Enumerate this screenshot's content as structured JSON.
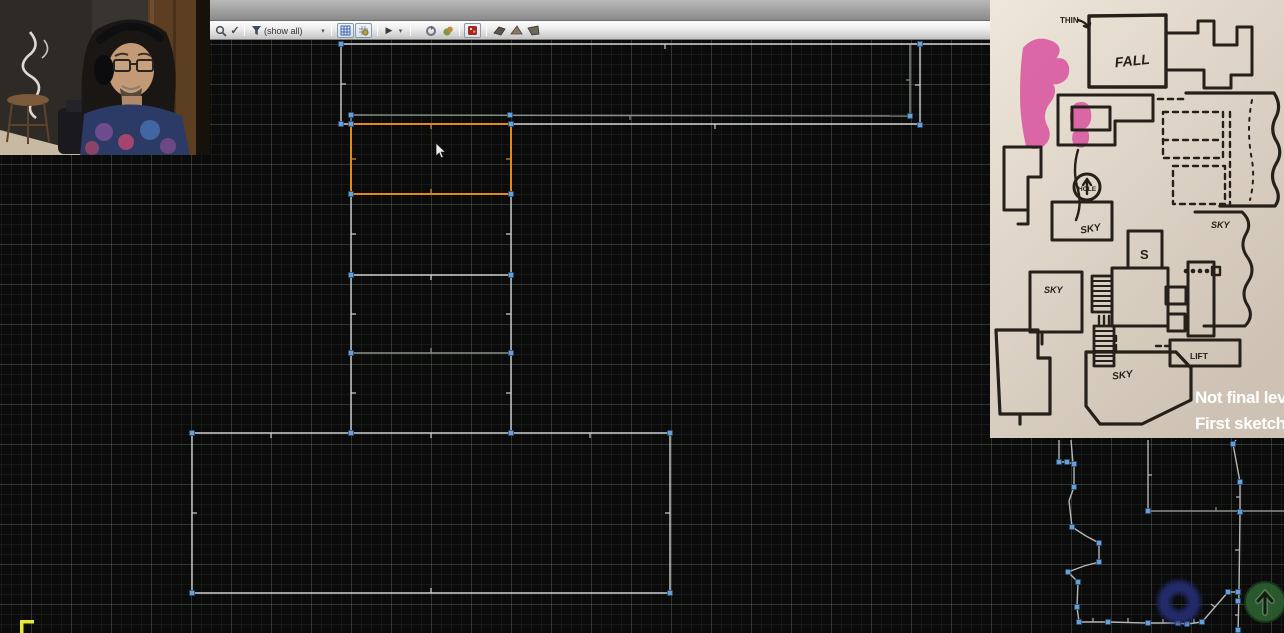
{
  "toolbar": {
    "filter_value": "(show all)",
    "play_glyph": "▶",
    "dropdown_glyph": "▾",
    "check_glyph": "✓"
  },
  "editor": {
    "colors": {
      "w": "#cfcfcf",
      "g": "#8b918b",
      "o": "#e1891f",
      "l": "#b7b7b7",
      "vertex": "#63a0dc",
      "thing_blue": "#202c6a",
      "thing_green": "#2c5f30"
    },
    "segments": [
      [
        341,
        44,
        992,
        44,
        "w"
      ],
      [
        341,
        44,
        341,
        124,
        "w"
      ],
      [
        920,
        45,
        920,
        125,
        "w"
      ],
      [
        910,
        45,
        910,
        116,
        "g"
      ],
      [
        351,
        115,
        910,
        116,
        "g"
      ],
      [
        341,
        124,
        920,
        124,
        "w"
      ],
      [
        351,
        115,
        351,
        124,
        "g"
      ],
      [
        192,
        433,
        670,
        433,
        "w"
      ],
      [
        192,
        433,
        192,
        593,
        "w"
      ],
      [
        670,
        433,
        670,
        593,
        "w"
      ],
      [
        192,
        593,
        670,
        593,
        "w"
      ],
      [
        351,
        194,
        351,
        433,
        "w"
      ],
      [
        511,
        194,
        511,
        433,
        "w"
      ],
      [
        351,
        275,
        511,
        275,
        "w"
      ],
      [
        351,
        353,
        511,
        353,
        "g"
      ],
      [
        351,
        124,
        511,
        124,
        "o"
      ],
      [
        351,
        124,
        351,
        194,
        "o"
      ],
      [
        511,
        124,
        511,
        194,
        "o"
      ],
      [
        351,
        194,
        511,
        194,
        "o"
      ],
      [
        1148,
        440,
        1148,
        511,
        "l"
      ],
      [
        1148,
        511,
        1284,
        511,
        "g"
      ],
      [
        1059,
        440,
        1059,
        462,
        "l"
      ],
      [
        1059,
        462,
        1067,
        462,
        "l"
      ],
      [
        1067,
        462,
        1074,
        464,
        "l"
      ],
      [
        1071,
        440,
        1073,
        464,
        "l"
      ],
      [
        1074,
        464,
        1074,
        487,
        "l"
      ],
      [
        1074,
        487,
        1069,
        501,
        "l"
      ],
      [
        1069,
        501,
        1072,
        527,
        "l"
      ],
      [
        1072,
        527,
        1086,
        536,
        "l"
      ],
      [
        1086,
        536,
        1099,
        543,
        "l"
      ],
      [
        1099,
        543,
        1099,
        562,
        "l"
      ],
      [
        1099,
        562,
        1084,
        566,
        "l"
      ],
      [
        1084,
        566,
        1068,
        572,
        "l"
      ],
      [
        1068,
        572,
        1078,
        582,
        "l"
      ],
      [
        1078,
        582,
        1077,
        607,
        "l"
      ],
      [
        1077,
        607,
        1079,
        622,
        "l"
      ],
      [
        1079,
        622,
        1108,
        622,
        "l"
      ],
      [
        1108,
        622,
        1148,
        623,
        "l"
      ],
      [
        1148,
        623,
        1178,
        623,
        "l"
      ],
      [
        1178,
        623,
        1187,
        624,
        "l"
      ],
      [
        1187,
        624,
        1202,
        622,
        "l"
      ],
      [
        1202,
        622,
        1228,
        592,
        "l"
      ],
      [
        1228,
        592,
        1238,
        592,
        "l"
      ],
      [
        1236,
        440,
        1233,
        444,
        "l"
      ],
      [
        1233,
        444,
        1240,
        482,
        "l"
      ],
      [
        1240,
        482,
        1240,
        512,
        "l"
      ],
      [
        1240,
        512,
        1239,
        592,
        "l"
      ],
      [
        1239,
        592,
        1238,
        633,
        "l"
      ]
    ],
    "ticks": [
      [
        665,
        44,
        665,
        49,
        "w"
      ],
      [
        341,
        84,
        346,
        84,
        "w"
      ],
      [
        920,
        85,
        915,
        85,
        "w"
      ],
      [
        910,
        80,
        906,
        80,
        "g"
      ],
      [
        630,
        115,
        630,
        120,
        "g"
      ],
      [
        715,
        124,
        715,
        129,
        "w"
      ],
      [
        431,
        124,
        431,
        129,
        "o"
      ],
      [
        431,
        194,
        431,
        189,
        "o"
      ],
      [
        351,
        159,
        356,
        159,
        "o"
      ],
      [
        511,
        159,
        506,
        159,
        "o"
      ],
      [
        351,
        234,
        356,
        234,
        "w"
      ],
      [
        351,
        314,
        356,
        314,
        "w"
      ],
      [
        351,
        393,
        356,
        393,
        "w"
      ],
      [
        511,
        234,
        506,
        234,
        "w"
      ],
      [
        511,
        314,
        506,
        314,
        "w"
      ],
      [
        511,
        393,
        506,
        393,
        "w"
      ],
      [
        431,
        275,
        431,
        280,
        "w"
      ],
      [
        431,
        353,
        431,
        348,
        "g"
      ],
      [
        271,
        433,
        271,
        438,
        "w"
      ],
      [
        431,
        433,
        431,
        438,
        "w"
      ],
      [
        590,
        433,
        590,
        438,
        "w"
      ],
      [
        192,
        513,
        197,
        513,
        "w"
      ],
      [
        670,
        513,
        665,
        513,
        "w"
      ],
      [
        431,
        593,
        431,
        588,
        "w"
      ],
      [
        1148,
        475,
        1152,
        475,
        "l"
      ],
      [
        1216,
        511,
        1216,
        507,
        "g"
      ],
      [
        1093,
        622,
        1093,
        618,
        "l"
      ],
      [
        1128,
        622,
        1128,
        618,
        "l"
      ],
      [
        1163,
        623,
        1163,
        619,
        "l"
      ],
      [
        1194,
        623,
        1194,
        619,
        "l"
      ],
      [
        1215,
        607,
        1211,
        604,
        "l"
      ],
      [
        1240,
        497,
        1236,
        497,
        "l"
      ],
      [
        1239,
        550,
        1235,
        550,
        "l"
      ],
      [
        1239,
        615,
        1235,
        615,
        "l"
      ]
    ],
    "vertices": [
      [
        341,
        44
      ],
      [
        920,
        44
      ],
      [
        351,
        115
      ],
      [
        510,
        115
      ],
      [
        910,
        116
      ],
      [
        341,
        124
      ],
      [
        351,
        124
      ],
      [
        511,
        124
      ],
      [
        920,
        125
      ],
      [
        351,
        194
      ],
      [
        511,
        194
      ],
      [
        351,
        275
      ],
      [
        511,
        275
      ],
      [
        351,
        353
      ],
      [
        511,
        353
      ],
      [
        192,
        433
      ],
      [
        351,
        433
      ],
      [
        511,
        433
      ],
      [
        670,
        433
      ],
      [
        192,
        593
      ],
      [
        670,
        593
      ],
      [
        1059,
        462
      ],
      [
        1067,
        462
      ],
      [
        1074,
        464
      ],
      [
        1074,
        487
      ],
      [
        1072,
        527
      ],
      [
        1099,
        543
      ],
      [
        1099,
        562
      ],
      [
        1068,
        572
      ],
      [
        1078,
        582
      ],
      [
        1077,
        607
      ],
      [
        1079,
        622
      ],
      [
        1108,
        622
      ],
      [
        1148,
        623
      ],
      [
        1178,
        623
      ],
      [
        1187,
        624
      ],
      [
        1202,
        622
      ],
      [
        1228,
        592
      ],
      [
        1238,
        592
      ],
      [
        1238,
        601
      ],
      [
        1238,
        630
      ],
      [
        1148,
        511
      ],
      [
        1233,
        444
      ],
      [
        1240,
        482
      ],
      [
        1240,
        512
      ]
    ],
    "things": {
      "torus": {
        "x": 1179,
        "y": 602,
        "r_mid": 15,
        "ring_width": 13
      },
      "player_start": {
        "x": 1265,
        "y": 602,
        "r": 20
      }
    },
    "cursor": {
      "x": 436,
      "y": 143
    },
    "yellow_marker": {
      "x": 20,
      "y": 620
    }
  },
  "sketch": {
    "labels": {
      "thin": "THIN",
      "fall": "FALL",
      "hole": "HOLE",
      "sky_script": "SKY",
      "s": "S",
      "sky_right": "SKY",
      "sky_left": "SKY",
      "sky_bottom": "SKY",
      "lift": "LIFT"
    },
    "caption": {
      "line1": "Not final leve",
      "line2": "First sketch."
    }
  }
}
